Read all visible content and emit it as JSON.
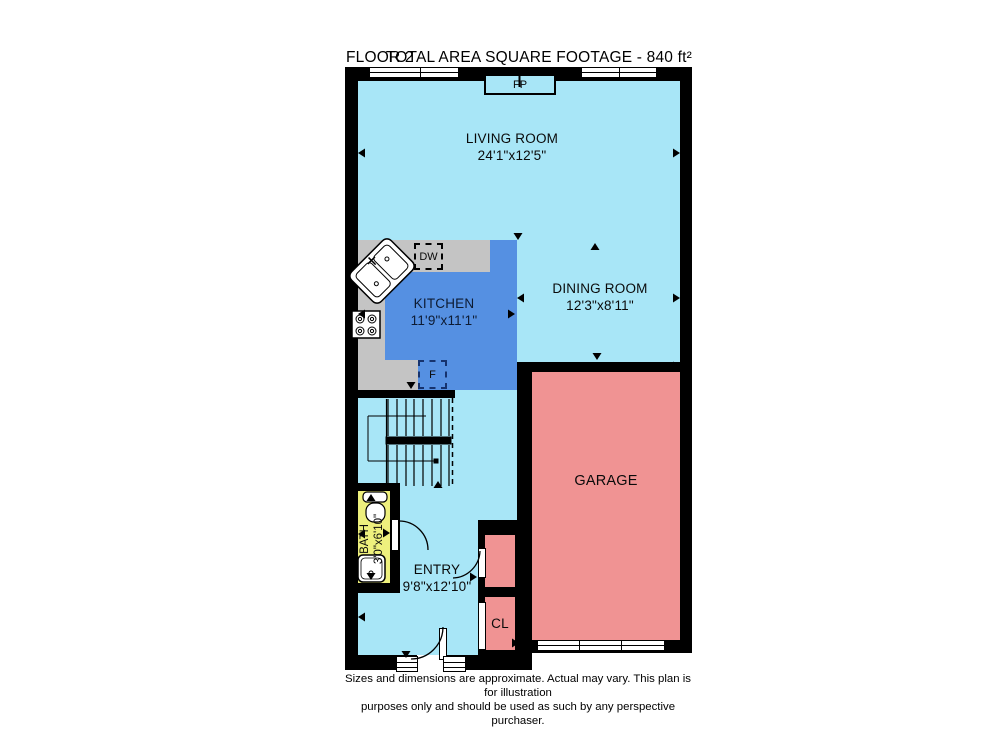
{
  "header": {
    "floor": "FLOOR 2",
    "area": "TOTAL AREA SQUARE FOOTAGE - 840 ft²"
  },
  "rooms": {
    "living": {
      "name": "LIVING ROOM",
      "dims": "24'1\"x12'5\""
    },
    "dining": {
      "name": "DINING ROOM",
      "dims": "12'3\"x8'11\""
    },
    "kitchen": {
      "name": "KITCHEN",
      "dims": "11'9\"x11'1\""
    },
    "garage": {
      "name": "GARAGE"
    },
    "bath": {
      "name": "BATH",
      "dims": "3'0\"x6'10\""
    },
    "entry": {
      "name": "ENTRY",
      "dims": "9'8\"x12'10\""
    },
    "closet": {
      "name": "CL"
    }
  },
  "fixtures": {
    "fireplace": "FP",
    "dishwasher": "DW",
    "furnace": "F"
  },
  "disclaimer": {
    "line1": "Sizes and dimensions are approximate. Actual may vary. This plan is for illustration",
    "line2": "purposes only and should be used as such by any perspective purchaser."
  },
  "colors": {
    "room_light_blue": "#a8e6f7",
    "kitchen_blue": "#5590e2",
    "garage_pink": "#f09393",
    "bath_yellow": "#eef07d",
    "counter_gray": "#c4c4c4",
    "wall_black": "#000000"
  }
}
